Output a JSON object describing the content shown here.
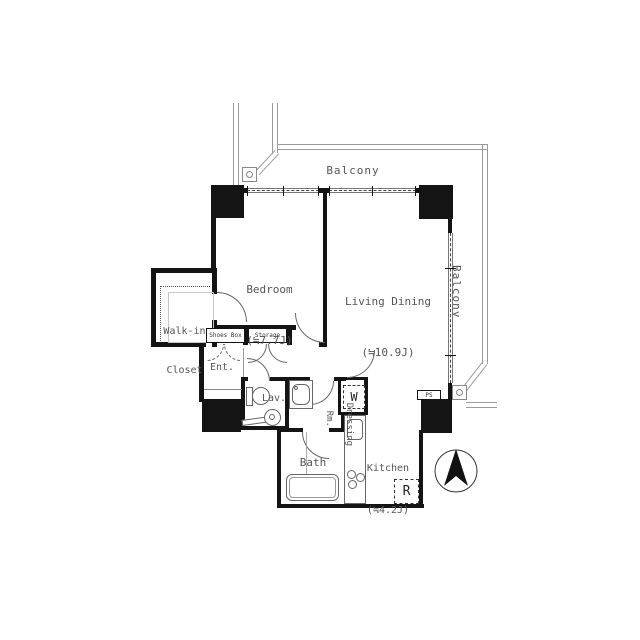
{
  "balcony": {
    "top_label": "Balcony",
    "right_label": "Balcony"
  },
  "rooms": {
    "bedroom": {
      "name": "Bedroom",
      "size": "(≒7.7J)"
    },
    "living_dining": {
      "name": "Living Dining",
      "size": "(≒10.9J)"
    },
    "kitchen": {
      "name": "Kitchen",
      "size": "(≒4.2J)"
    },
    "walk_in_closet": {
      "name_line1": "Walk-in",
      "name_line2": "Closet"
    },
    "entrance": {
      "name": "Ent."
    },
    "lavatory": {
      "name": "Lav."
    },
    "dressing_room": {
      "name_line1": "Dressing",
      "name_line2": "Rm."
    },
    "bath": {
      "name": "Bath"
    }
  },
  "fixtures": {
    "shoes_box": "Shoes Box",
    "storage": "Storage",
    "washing_machine": "W",
    "refrigerator": "R",
    "pipe_space": "PS"
  },
  "compass": {
    "symbol": "north-arrow"
  },
  "colors": {
    "wall": "#141414",
    "balcony_line": "#9a9a9a",
    "text": "#555555",
    "background": "#ffffff"
  }
}
